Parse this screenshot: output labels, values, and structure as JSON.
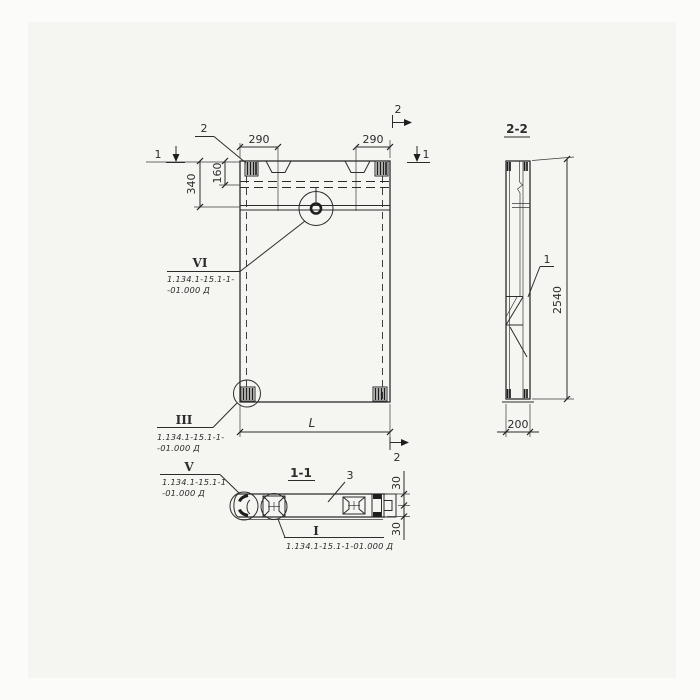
{
  "views": {
    "front": {
      "dims": {
        "d290_left": "290",
        "d290_right": "290",
        "d160": "160",
        "d340": "340",
        "length": "L"
      },
      "marks": {
        "cut1_left": "1",
        "cut1_right": "1",
        "cut2_top": "2",
        "cut2_bottom": "2",
        "callout_2": "2"
      },
      "details": {
        "vi": {
          "label": "VI",
          "doc_line1": "1.134.1-15.1-1-",
          "doc_line2": "-01.000 Д"
        },
        "iii": {
          "label": "III",
          "doc_line1": "1.134.1-15.1-1-",
          "doc_line2": "-01.000 Д"
        }
      }
    },
    "section22": {
      "title": "2-2",
      "d2540": "2540",
      "d200": "200",
      "callout_1": "1"
    },
    "section11": {
      "title": "1-1",
      "callout_3": "3",
      "d30_top": "30",
      "d30_bottom": "30",
      "details": {
        "v": {
          "label": "V",
          "doc_line1": "1.134.1-15.1-1",
          "doc_line2": "-01.000 Д"
        },
        "i": {
          "label": "I",
          "doc_line": "1.134.1-15.1-1-01.000 Д"
        }
      }
    },
    "colors": {
      "line": "#2c2c2c",
      "paper": "#f5f5f2"
    }
  }
}
